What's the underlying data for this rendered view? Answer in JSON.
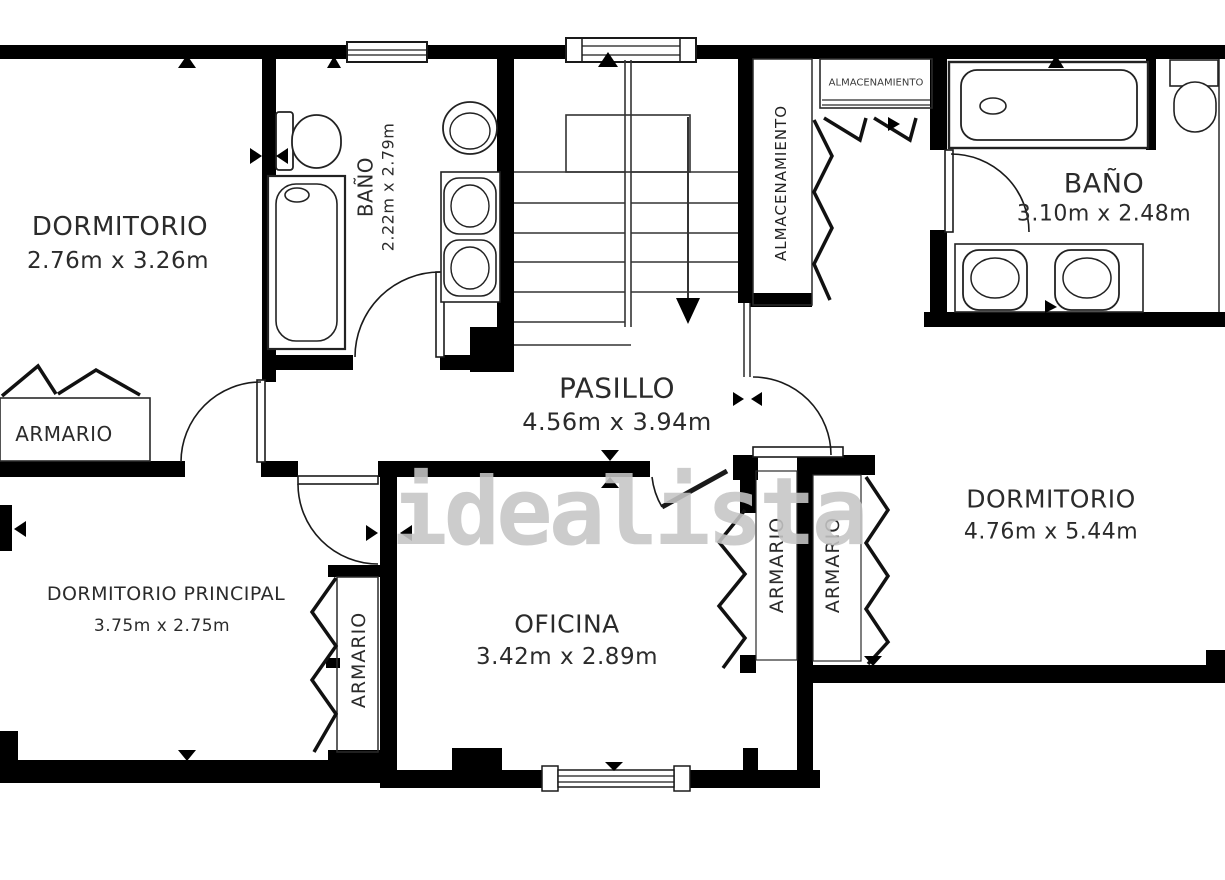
{
  "plan": {
    "watermark": "idealista",
    "colors": {
      "wall": "#000000",
      "background": "#ffffff",
      "text": "#2b2b2b",
      "watermark": "#c5c5c5"
    },
    "rooms": {
      "dormitorio1": {
        "name": "DORMITORIO",
        "dims": "2.76m x 3.26m"
      },
      "bano1": {
        "name": "BAÑO",
        "dims": "2.22m x 2.79m"
      },
      "almacenamiento_v": {
        "name": "ALMACENAMIENTO"
      },
      "almacenamiento_box": {
        "name": "ALMACENAMIENTO"
      },
      "bano2": {
        "name": "BAÑO",
        "dims": "3.10m x 2.48m"
      },
      "pasillo": {
        "name": "PASILLO",
        "dims": "4.56m x 3.94m"
      },
      "armario1": {
        "name": "ARMARIO"
      },
      "dormitorio_ppal": {
        "name": "DORMITORIO PRINCIPAL",
        "dims": "3.75m x 2.75m"
      },
      "armario2": {
        "name": "ARMARIO"
      },
      "oficina": {
        "name": "OFICINA",
        "dims": "3.42m x 2.89m"
      },
      "armario3": {
        "name": "ARMARIO"
      },
      "armario4": {
        "name": "ARMARIO"
      },
      "dormitorio2": {
        "name": "DORMITORIO",
        "dims": "4.76m x 5.44m"
      }
    }
  }
}
